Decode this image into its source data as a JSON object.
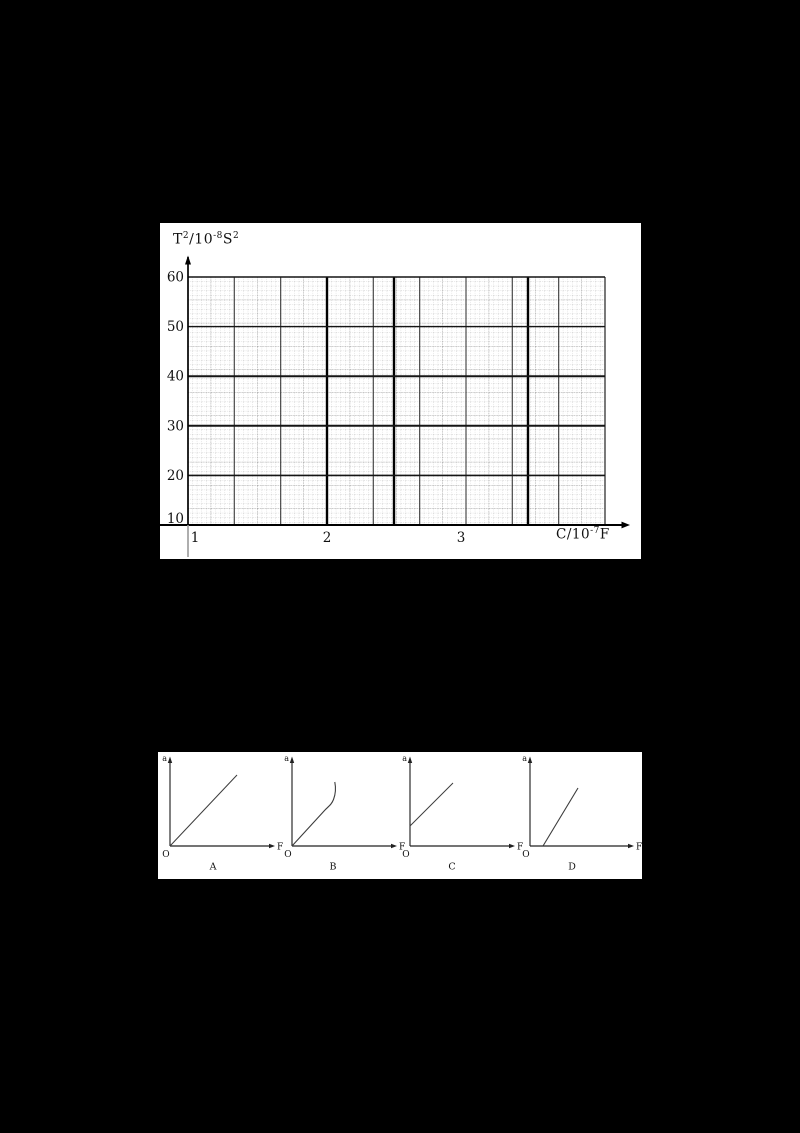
{
  "page": {
    "background": "#000000",
    "panel_background": "#ffffff",
    "ink_color": "#1a1a1a"
  },
  "top_chart": {
    "y_title": {
      "t": "T",
      "t_sup": "2",
      "slash": "/10",
      "exp": "-8",
      "s": "S",
      "s_sup": "2"
    },
    "x_title": {
      "base": "C/10",
      "exp": "-7",
      "unit": "F"
    },
    "y_ticks": [
      "60",
      "50",
      "40",
      "30",
      "20",
      "10"
    ],
    "x_ticks": [
      "1",
      "2",
      "3"
    ]
  },
  "options": [
    {
      "label": "A",
      "y_axis": "a",
      "x_axis": "F",
      "origin": "O"
    },
    {
      "label": "B",
      "y_axis": "a",
      "x_axis": "F",
      "origin": "O"
    },
    {
      "label": "C",
      "y_axis": "a",
      "x_axis": "F",
      "origin": "O"
    },
    {
      "label": "D",
      "y_axis": "a",
      "x_axis": "F",
      "origin": "O"
    }
  ],
  "chart_data": [
    {
      "type": "line",
      "title": "Empty millimeter graph-paper grid for plotting T² against C (no data series plotted)",
      "xlabel": "C/10⁻⁷F",
      "ylabel": "T²/10⁻⁸S²",
      "x_ticks": [
        1,
        2,
        3
      ],
      "y_ticks": [
        10,
        20,
        30,
        40,
        50,
        60
      ],
      "xlim": [
        1,
        4.1
      ],
      "ylim": [
        10,
        60
      ],
      "grid": true,
      "grid_style": "dense scanned millimeter paper: dotted minor lines, gray medium lines every 5 small squares, dark major lines; heavy vertical lines near C = 2, 2.5 and 3.5",
      "legend": false,
      "series": []
    },
    {
      "type": "line",
      "label": "A",
      "xlabel": "F",
      "ylabel": "a",
      "description": "straight line passing through the origin",
      "x": [
        0,
        0.66
      ],
      "y": [
        0,
        0.8
      ]
    },
    {
      "type": "line",
      "label": "B",
      "xlabel": "F",
      "ylabel": "a",
      "description": "line from the origin, initially straight then curving upward and becoming nearly vertical",
      "x": [
        0,
        0.33,
        0.42,
        0.43
      ],
      "y": [
        0,
        0.4,
        0.62,
        0.72
      ]
    },
    {
      "type": "line",
      "label": "C",
      "xlabel": "F",
      "ylabel": "a",
      "description": "straight line starting from a positive intercept on the a-axis",
      "x": [
        0,
        0.43
      ],
      "y": [
        0.22,
        0.71
      ]
    },
    {
      "type": "line",
      "label": "D",
      "xlabel": "F",
      "ylabel": "a",
      "description": "steep straight line starting from a positive intercept on the F-axis",
      "x": [
        0.13,
        0.48
      ],
      "y": [
        0,
        0.65
      ]
    }
  ]
}
